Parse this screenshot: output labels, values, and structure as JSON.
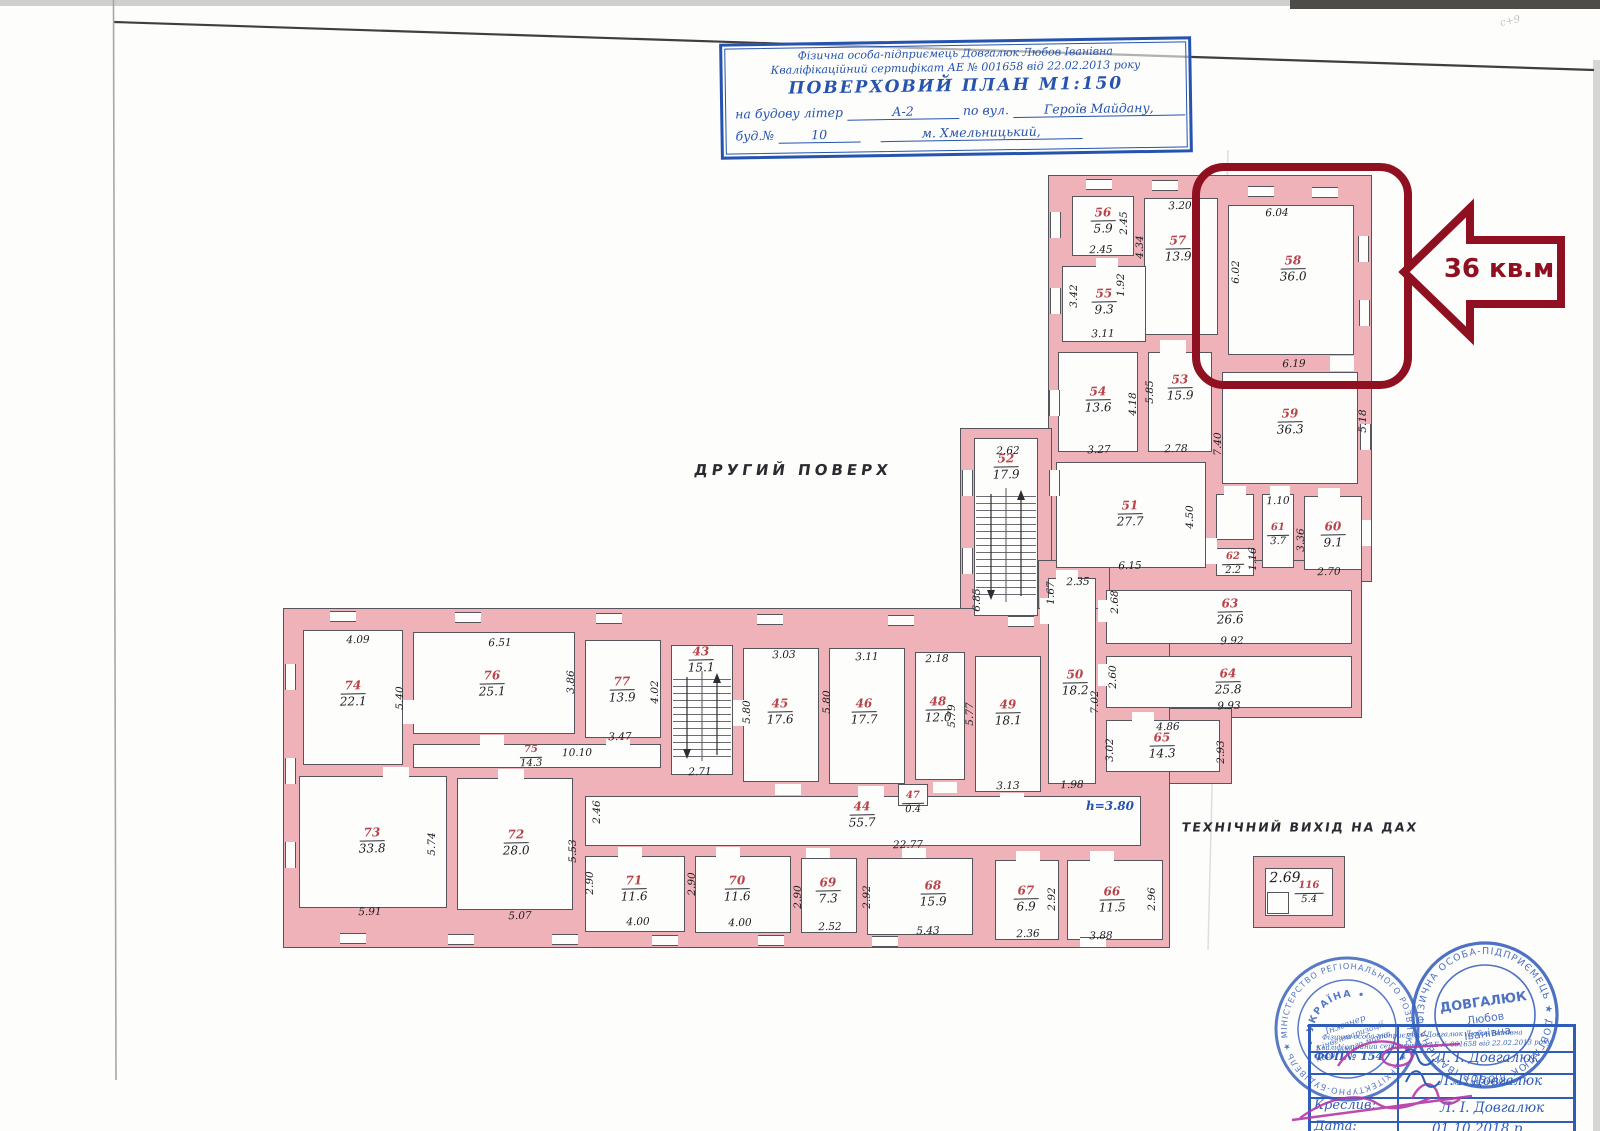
{
  "document": {
    "title_block": {
      "line1": "Фізична особа-підприємець Довгалюк Любов Іванівна",
      "line2": "Кваліфікаційний сертифікат АЕ № 001658 від 22.02.2013 року",
      "line3": "ПОВЕРХОВИЙ ПЛАН   М1:150",
      "line4_prefix": "на будову літер",
      "line4_value": "А-2",
      "line4_mid": "по вул.",
      "line4_street": "Героїв Майдану,",
      "line5_prefix": "буд.№",
      "line5_value": "10",
      "line5_city": "м. Хмельницький,"
    },
    "floor_label": "ДРУГИЙ ПОВЕРХ",
    "roof_exit_label": "ТЕХНІЧНИЙ ВИХІД НА ДАХ",
    "height_note": "h=3.80"
  },
  "highlight": {
    "callout": "36 кв.м.",
    "room_number": "58",
    "color": "#8f1020"
  },
  "rooms": [
    {
      "n": "56",
      "a": "5.9"
    },
    {
      "n": "57",
      "a": "13.9"
    },
    {
      "n": "55",
      "a": "9.3"
    },
    {
      "n": "58",
      "a": "36.0"
    },
    {
      "n": "54",
      "a": "13.6"
    },
    {
      "n": "53",
      "a": "15.9"
    },
    {
      "n": "59",
      "a": "36.3"
    },
    {
      "n": "52",
      "a": "17.9"
    },
    {
      "n": "51",
      "a": "27.7"
    },
    {
      "n": "61",
      "a": "3.7"
    },
    {
      "n": "60",
      "a": "9.1"
    },
    {
      "n": "62",
      "a": "2.2"
    },
    {
      "n": "63",
      "a": "26.6"
    },
    {
      "n": "64",
      "a": "25.8"
    },
    {
      "n": "65",
      "a": "14.3"
    },
    {
      "n": "50",
      "a": "18.2"
    },
    {
      "n": "74",
      "a": "22.1"
    },
    {
      "n": "76",
      "a": "25.1"
    },
    {
      "n": "77",
      "a": "13.9"
    },
    {
      "n": "43",
      "a": "15.1"
    },
    {
      "n": "45",
      "a": "17.6"
    },
    {
      "n": "46",
      "a": "17.7"
    },
    {
      "n": "48",
      "a": "12.0"
    },
    {
      "n": "49",
      "a": "18.1"
    },
    {
      "n": "75",
      "a": "14.3"
    },
    {
      "n": "44",
      "a": "55.7"
    },
    {
      "n": "47",
      "a": "0.4"
    },
    {
      "n": "73",
      "a": "33.8"
    },
    {
      "n": "72",
      "a": "28.0"
    },
    {
      "n": "71",
      "a": "11.6"
    },
    {
      "n": "70",
      "a": "11.6"
    },
    {
      "n": "69",
      "a": "7.3"
    },
    {
      "n": "68",
      "a": "15.9"
    },
    {
      "n": "67",
      "a": "6.9"
    },
    {
      "n": "66",
      "a": "11.5"
    },
    {
      "n": "116",
      "a": "5.4"
    }
  ],
  "dims": [
    "4.09",
    "5.40",
    "6.51",
    "3.86",
    "3.47",
    "4.02",
    "10.10",
    "2.71",
    "5.80",
    "3.03",
    "5.80",
    "3.11",
    "2.18",
    "5.79",
    "5.77",
    "3.13",
    "1.98",
    "5.91",
    "5.74",
    "5.07",
    "2.90",
    "4.00",
    "2.90",
    "4.00",
    "2.90",
    "2.52",
    "2.92",
    "5.43",
    "2.36",
    "3.88",
    "2.96",
    "2.92",
    "2.46",
    "5.53",
    "22.77",
    "2.45",
    "2.45",
    "3.20",
    "4.34",
    "1.92",
    "3.42",
    "3.11",
    "6.04",
    "6.02",
    "6.19",
    "5.85",
    "4.18",
    "3.27",
    "2.78",
    "7.40",
    "5.18",
    "2.62",
    "6.85",
    "1.10",
    "3.36",
    "2.70",
    "1.16",
    "6.15",
    "4.50",
    "2.35",
    "1.67",
    "2.68",
    "2.60",
    "7.02",
    "9.92",
    "9.93",
    "4.86",
    "3.02",
    "2.93",
    "2.69"
  ],
  "stamps": {
    "round1": {
      "ring": "★ МІНІСТЕРСТВО РЕГІОНАЛЬНОГО РОЗВИТКУ ★ АРХІТЕКТУРНО-БУДІВЕЛЬНА КОМІСІЯ",
      "arc": "• УКРАЇНА •",
      "center1": "Інженер",
      "center2": "з інвентаризації",
      "center3": "нерухомого майна"
    },
    "round2": {
      "ring": "ФІЗИЧНА ОСОБА-ПІДПРИЄМЕЦЬ ★ ДОВГАЛЮК ЛЮБОВ ІВАНІВНА ★",
      "center1": "ДОВГАЛЮК",
      "center2": "Любов",
      "center3": "Іванівна"
    },
    "table": {
      "overlay1": "Фізична особа-підприємець Довгалюк Любов Іванівна",
      "overlay2": "Кваліфікаційний сертифікат АЕ № 001658 від 22.02.2013 року",
      "overlay3": "м. Хмельницьк",
      "row1_label": "ФОП№ 1547",
      "row1_value": "Л. І. Довгалюк",
      "row2_value": "Л. І. Довгалюк",
      "row3_label": "Креслив:",
      "row3_value": "Л. І. Довгалюк",
      "row4_label": "Дата:",
      "row4_value": "01.10.2018 р."
    }
  },
  "artifacts": {
    "pencil_note": "с+9"
  }
}
